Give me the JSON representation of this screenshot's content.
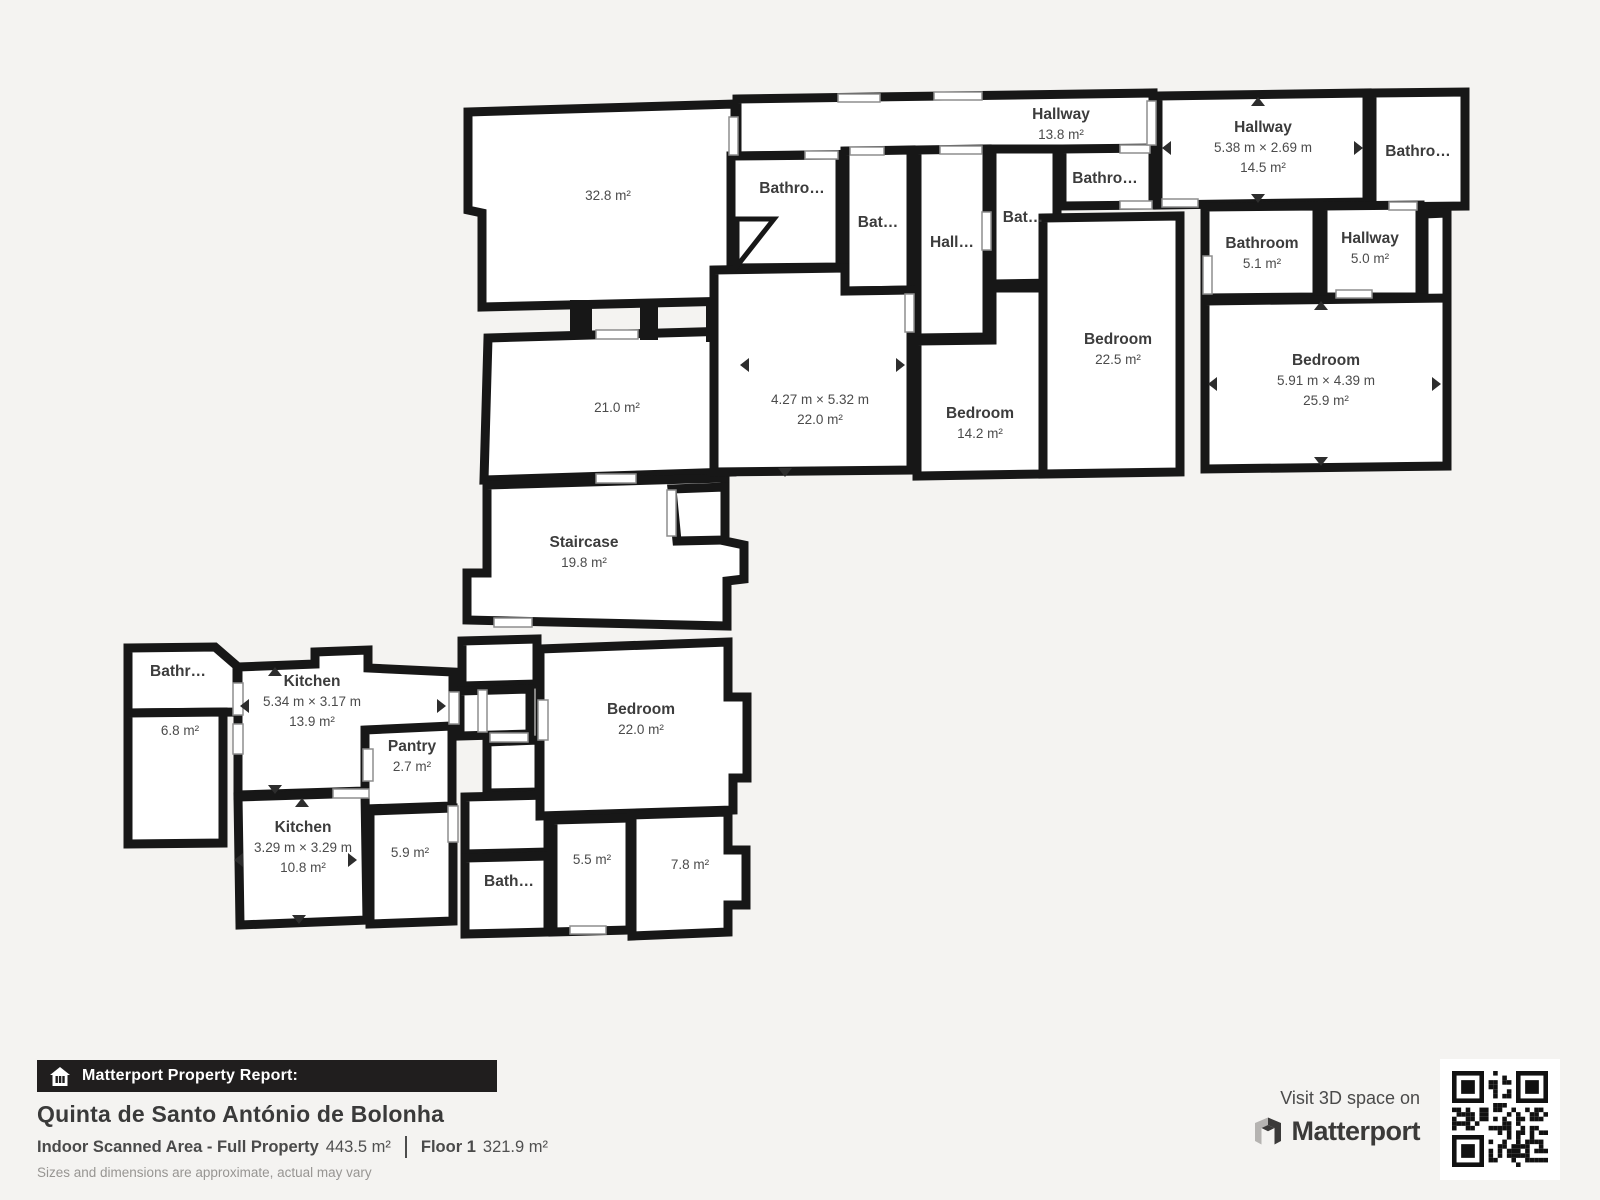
{
  "colors": {
    "background": "#f4f3f1",
    "wall": "#171717",
    "room_fill": "#ffffff",
    "label_text": "#3c3c3c",
    "footer_bar": "#201e1e",
    "footer_text": "#4a4a4a",
    "disclaimer_text": "#979592"
  },
  "plan": {
    "rooms": [
      {
        "id": "hallway-top",
        "name": "Hallway",
        "area": "13.8 m²"
      },
      {
        "id": "room-32-8",
        "area": "32.8 m²"
      },
      {
        "id": "room-21-0",
        "area": "21.0 m²"
      },
      {
        "id": "staircase",
        "name": "Staircase",
        "area": "19.8 m²"
      },
      {
        "id": "bathroom-1",
        "name": "Bathro…"
      },
      {
        "id": "bathroom-2",
        "name": "Bat…"
      },
      {
        "id": "hallway-inner",
        "name": "Hall…"
      },
      {
        "id": "bathroom-3",
        "name": "Bat…"
      },
      {
        "id": "bathroom-4",
        "name": "Bathro…"
      },
      {
        "id": "room-22-0",
        "dims": "4.27 m × 5.32 m",
        "area": "22.0 m²"
      },
      {
        "id": "bedroom-14-2",
        "name": "Bedroom",
        "area": "14.2 m²"
      },
      {
        "id": "bedroom-22-5",
        "name": "Bedroom",
        "area": "22.5 m²"
      },
      {
        "id": "hallway-14-5",
        "name": "Hallway",
        "dims": "5.38 m × 2.69 m",
        "area": "14.5 m²"
      },
      {
        "id": "bathroom-top-right",
        "name": "Bathro…"
      },
      {
        "id": "bathroom-5-1",
        "name": "Bathroom",
        "area": "5.1 m²"
      },
      {
        "id": "hallway-5-0",
        "name": "Hallway",
        "area": "5.0 m²"
      },
      {
        "id": "bedroom-25-9",
        "name": "Bedroom",
        "dims": "5.91 m × 4.39 m",
        "area": "25.9 m²"
      },
      {
        "id": "bathroom-bottom-left",
        "name": "Bathr…"
      },
      {
        "id": "room-6-8",
        "area": "6.8 m²"
      },
      {
        "id": "kitchen-13-9",
        "name": "Kitchen",
        "dims": "5.34 m × 3.17 m",
        "area": "13.9 m²"
      },
      {
        "id": "pantry",
        "name": "Pantry",
        "area": "2.7 m²"
      },
      {
        "id": "kitchen-10-8",
        "name": "Kitchen",
        "dims": "3.29 m × 3.29 m",
        "area": "10.8 m²"
      },
      {
        "id": "room-5-9",
        "area": "5.9 m²"
      },
      {
        "id": "bathroom-bottom",
        "name": "Bath…"
      },
      {
        "id": "bedroom-22-0",
        "name": "Bedroom",
        "area": "22.0 m²"
      },
      {
        "id": "room-5-5",
        "area": "5.5 m²"
      },
      {
        "id": "room-7-8",
        "area": "7.8 m²"
      }
    ]
  },
  "footer": {
    "report_label": "Matterport Property Report:",
    "property_name": "Quinta de Santo António de Bolonha",
    "scanned_area_label": "Indoor Scanned Area - Full Property",
    "scanned_area_value": "443.5 m²",
    "floor_label": "Floor 1",
    "floor_value": "321.9 m²",
    "disclaimer": "Sizes and dimensions are approximate, actual may vary",
    "visit_label": "Visit 3D space on",
    "brand_name": "Matterport"
  }
}
